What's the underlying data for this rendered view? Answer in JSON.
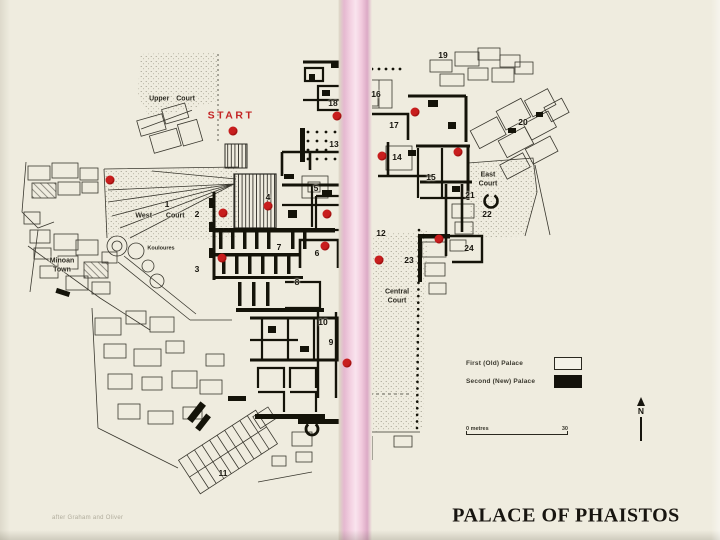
{
  "title": {
    "text": "PALACE OF PHAISTOS"
  },
  "attribution": {
    "text": "after Graham and Oliver"
  },
  "compass": {
    "label": "N"
  },
  "scale_bar": {
    "left_label": "0 metres",
    "right_label": "30"
  },
  "legend": {
    "items": [
      {
        "label": "First (Old) Palace",
        "swatch": "open"
      },
      {
        "label": "Second (New) Palace",
        "swatch": "solid"
      }
    ]
  },
  "colors": {
    "paper": "#efecdf",
    "binding_pink": "#f3cde0",
    "marker_red": "#c81e1e",
    "ink": "#17150e",
    "start_red": "#c32424"
  },
  "map": {
    "area_labels": [
      {
        "name": "start",
        "lines": [
          "START"
        ],
        "x": 231,
        "y": 116,
        "size": 10.5,
        "variant": "start"
      },
      {
        "name": "upper-court",
        "lines": [
          "Upper Court"
        ],
        "x": 172,
        "y": 100,
        "size": 7
      },
      {
        "name": "west-court",
        "lines": [
          "West  Court"
        ],
        "x": 160,
        "y": 217,
        "size": 7
      },
      {
        "name": "minoan-town",
        "lines": [
          "Minoan",
          "Town"
        ],
        "x": 62,
        "y": 266,
        "size": 7
      },
      {
        "name": "kouloures",
        "lines": [
          "Kouloures"
        ],
        "x": 161,
        "y": 249,
        "size": 5.5
      },
      {
        "name": "central-court",
        "lines": [
          "Central",
          "Court"
        ],
        "x": 397,
        "y": 297,
        "size": 7
      },
      {
        "name": "east-court",
        "lines": [
          "East",
          "Court"
        ],
        "x": 488,
        "y": 180,
        "size": 7
      }
    ],
    "numbers": [
      {
        "n": "1",
        "x": 167,
        "y": 204
      },
      {
        "n": "2",
        "x": 197,
        "y": 214
      },
      {
        "n": "3",
        "x": 197,
        "y": 269
      },
      {
        "n": "4",
        "x": 268,
        "y": 197
      },
      {
        "n": "5",
        "x": 316,
        "y": 188
      },
      {
        "n": "6",
        "x": 317,
        "y": 253
      },
      {
        "n": "7",
        "x": 279,
        "y": 247
      },
      {
        "n": "8",
        "x": 297,
        "y": 282
      },
      {
        "n": "9",
        "x": 331,
        "y": 342
      },
      {
        "n": "10",
        "x": 323,
        "y": 322
      },
      {
        "n": "11",
        "x": 223,
        "y": 473
      },
      {
        "n": "12",
        "x": 381,
        "y": 233
      },
      {
        "n": "13",
        "x": 334,
        "y": 144
      },
      {
        "n": "14",
        "x": 397,
        "y": 157
      },
      {
        "n": "15",
        "x": 431,
        "y": 177
      },
      {
        "n": "16",
        "x": 376,
        "y": 94
      },
      {
        "n": "17",
        "x": 394,
        "y": 125
      },
      {
        "n": "18",
        "x": 333,
        "y": 103
      },
      {
        "n": "19",
        "x": 443,
        "y": 55
      },
      {
        "n": "20",
        "x": 523,
        "y": 122
      },
      {
        "n": "21",
        "x": 470,
        "y": 195
      },
      {
        "n": "22",
        "x": 487,
        "y": 214
      },
      {
        "n": "23",
        "x": 409,
        "y": 260
      },
      {
        "n": "24",
        "x": 469,
        "y": 248
      }
    ],
    "dots": [
      {
        "x": 233,
        "y": 131
      },
      {
        "x": 110,
        "y": 180
      },
      {
        "x": 223,
        "y": 213
      },
      {
        "x": 268,
        "y": 206
      },
      {
        "x": 327,
        "y": 214
      },
      {
        "x": 222,
        "y": 258
      },
      {
        "x": 325,
        "y": 246
      },
      {
        "x": 337,
        "y": 116
      },
      {
        "x": 415,
        "y": 112
      },
      {
        "x": 382,
        "y": 156
      },
      {
        "x": 458,
        "y": 152
      },
      {
        "x": 439,
        "y": 239
      },
      {
        "x": 379,
        "y": 260
      },
      {
        "x": 347,
        "y": 363
      }
    ]
  }
}
